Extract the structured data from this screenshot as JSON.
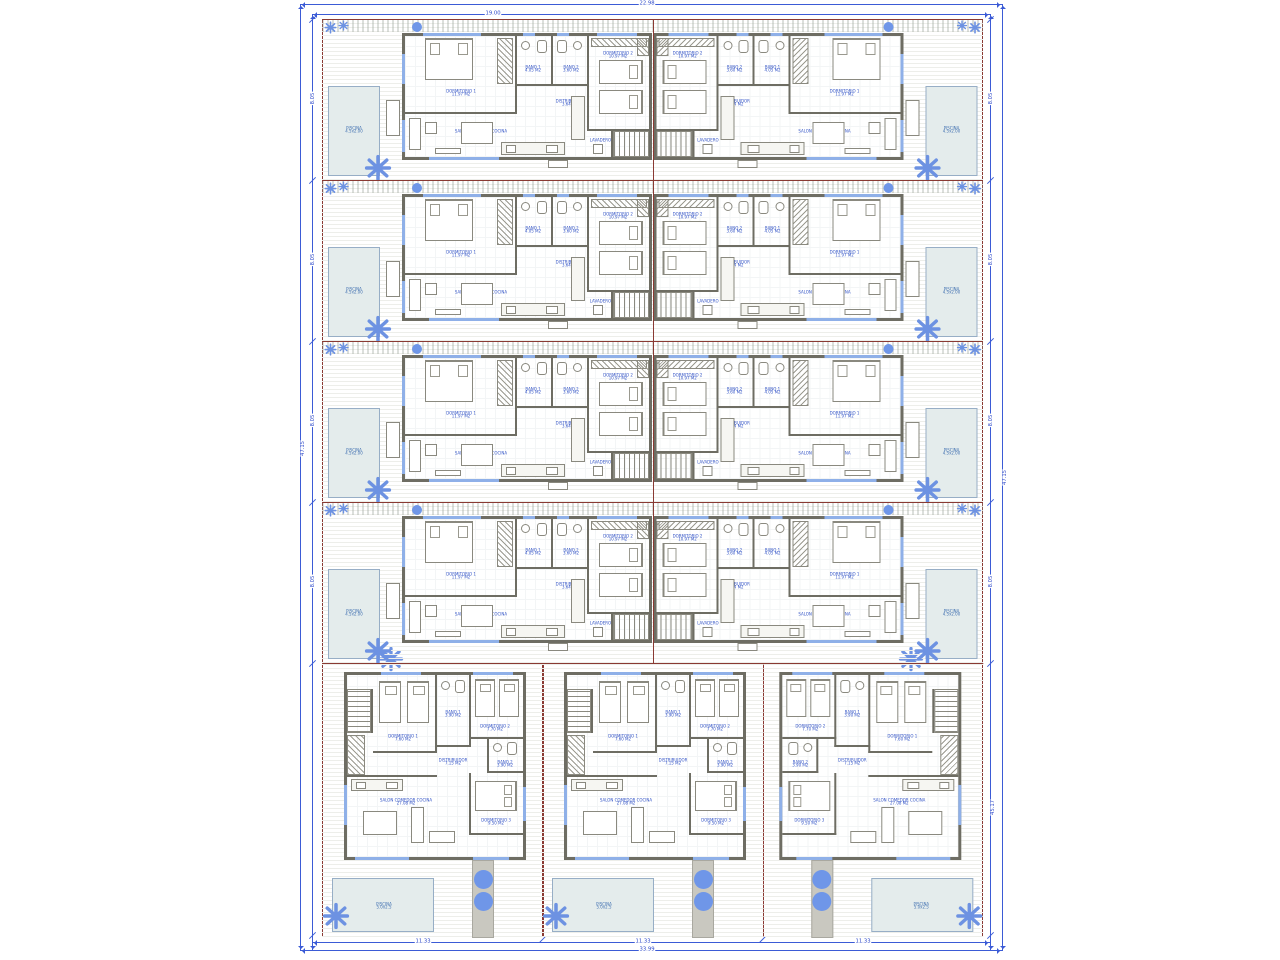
{
  "drawing": {
    "type": "architectural-site-plan",
    "dimensions": {
      "top_total": "22.98",
      "top_inner": "19.00",
      "left_total": "47.15",
      "row_height": "8.05",
      "right_total": "47.15",
      "right_inner": "45.17",
      "villa_width": "11.33",
      "bottom_total": "33.99"
    },
    "unit": {
      "dormitorio1": "DORMITORIO 1",
      "dormitorio1_area": "11.97 M2",
      "dormitorio2": "DORMITORIO 2",
      "dormitorio2_area": "10.97 M2",
      "bano1": "BAÑO 1",
      "bano1_area": "4.05 M2",
      "bano2": "BAÑO 2",
      "bano2_area": "3.60 M2",
      "distribuidor": "DISTRIBUIDOR",
      "distribuidor_area": "3.64 M2",
      "salon": "SALON COMEDOR COCINA",
      "salon_area": "25.08 M2",
      "lavadero": "LAVADERO",
      "piscina": "PISCINA",
      "piscina_size": "4.5x2.00"
    },
    "villa": {
      "dormitorio1": "DORMITORIO 1",
      "dormitorio1_area": "7.60 M2",
      "dormitorio2": "DORMITORIO 2",
      "dormitorio2_area": "7.70 M2",
      "dormitorio3": "DORMITORIO 3",
      "dormitorio3_area": "9.50 M2",
      "bano1": "BAÑO 1",
      "bano1_area": "3.90 M2",
      "bano2": "BAÑO 2",
      "bano2_area": "3.90 M2",
      "distribuidor": "DISTRIBUIDOR",
      "distribuidor_area": "7.15 M2",
      "salon": "SALON COMEDOR COCINA",
      "salon_area": "27.08 M2",
      "piscina": "PISCINA",
      "piscina_size": "5.0x2.5"
    },
    "colors": {
      "boundary": "#8a3a33",
      "dimension": "#3b5bd6",
      "wall": "#6e6d63",
      "window": "#8fb0e8",
      "pool": "#e4ecec",
      "plant": "#6d92e2",
      "label": "#3253c6"
    },
    "layout": {
      "rows": 4,
      "row_tops": [
        19,
        180,
        341,
        502
      ],
      "villa_lefts": [
        322,
        542.3,
        762.6
      ],
      "villa_mirrored_index": 2
    }
  }
}
